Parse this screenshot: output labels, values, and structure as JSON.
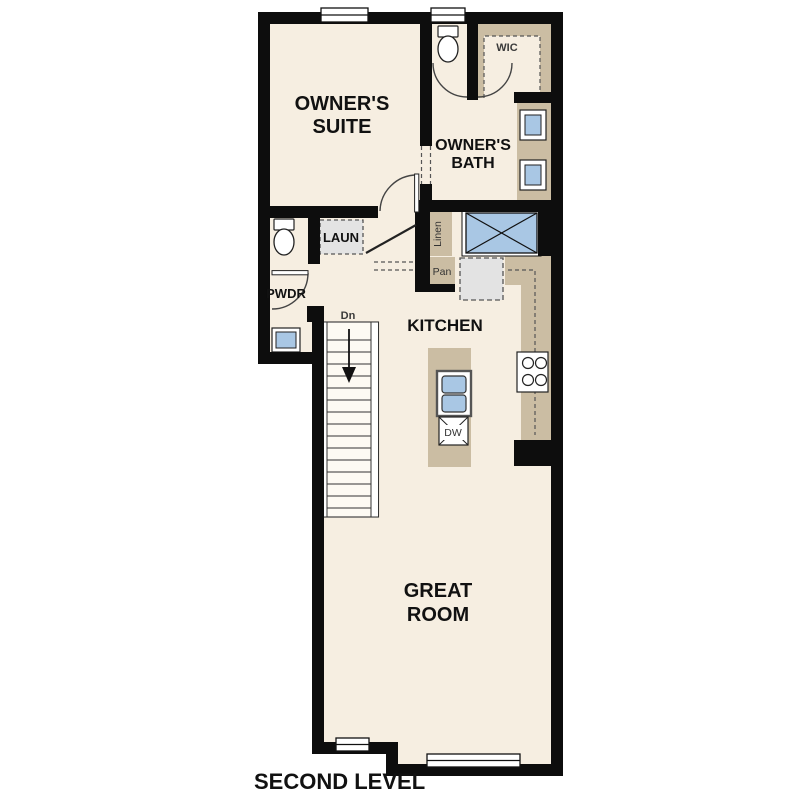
{
  "title": "SECOND LEVEL",
  "colors": {
    "background": "#ffffff",
    "wall": "#0d0d0d",
    "floor_cream": "#f6eee1",
    "cabinet_tan": "#cbbda3",
    "fixture_blue": "#a9c7e4",
    "appliance_gray": "#e3e3e3",
    "label_text": "#111111"
  },
  "plan": {
    "rooms": {
      "owners_suite": {
        "line1": "OWNER'S",
        "line2": "SUITE"
      },
      "owners_bath": {
        "line1": "OWNER'S",
        "line2": "BATH"
      },
      "wic": {
        "label": "WIC"
      },
      "laundry": {
        "label": "LAUN"
      },
      "powder": {
        "label": "PWDR"
      },
      "kitchen": {
        "label": "KITCHEN"
      },
      "great_room": {
        "line1": "GREAT",
        "line2": "ROOM"
      },
      "linen": {
        "label": "Linen"
      },
      "pantry": {
        "label": "Pan"
      }
    },
    "annotations": {
      "stairs_down": "Dn",
      "dishwasher": "DW"
    },
    "fixtures": [
      "window",
      "toilet",
      "shower",
      "double-vanity-sink",
      "powder-sink",
      "refrigerator",
      "range-cooktop",
      "island-double-sink",
      "dishwasher",
      "staircase-down",
      "door-swing",
      "cased-opening"
    ]
  }
}
